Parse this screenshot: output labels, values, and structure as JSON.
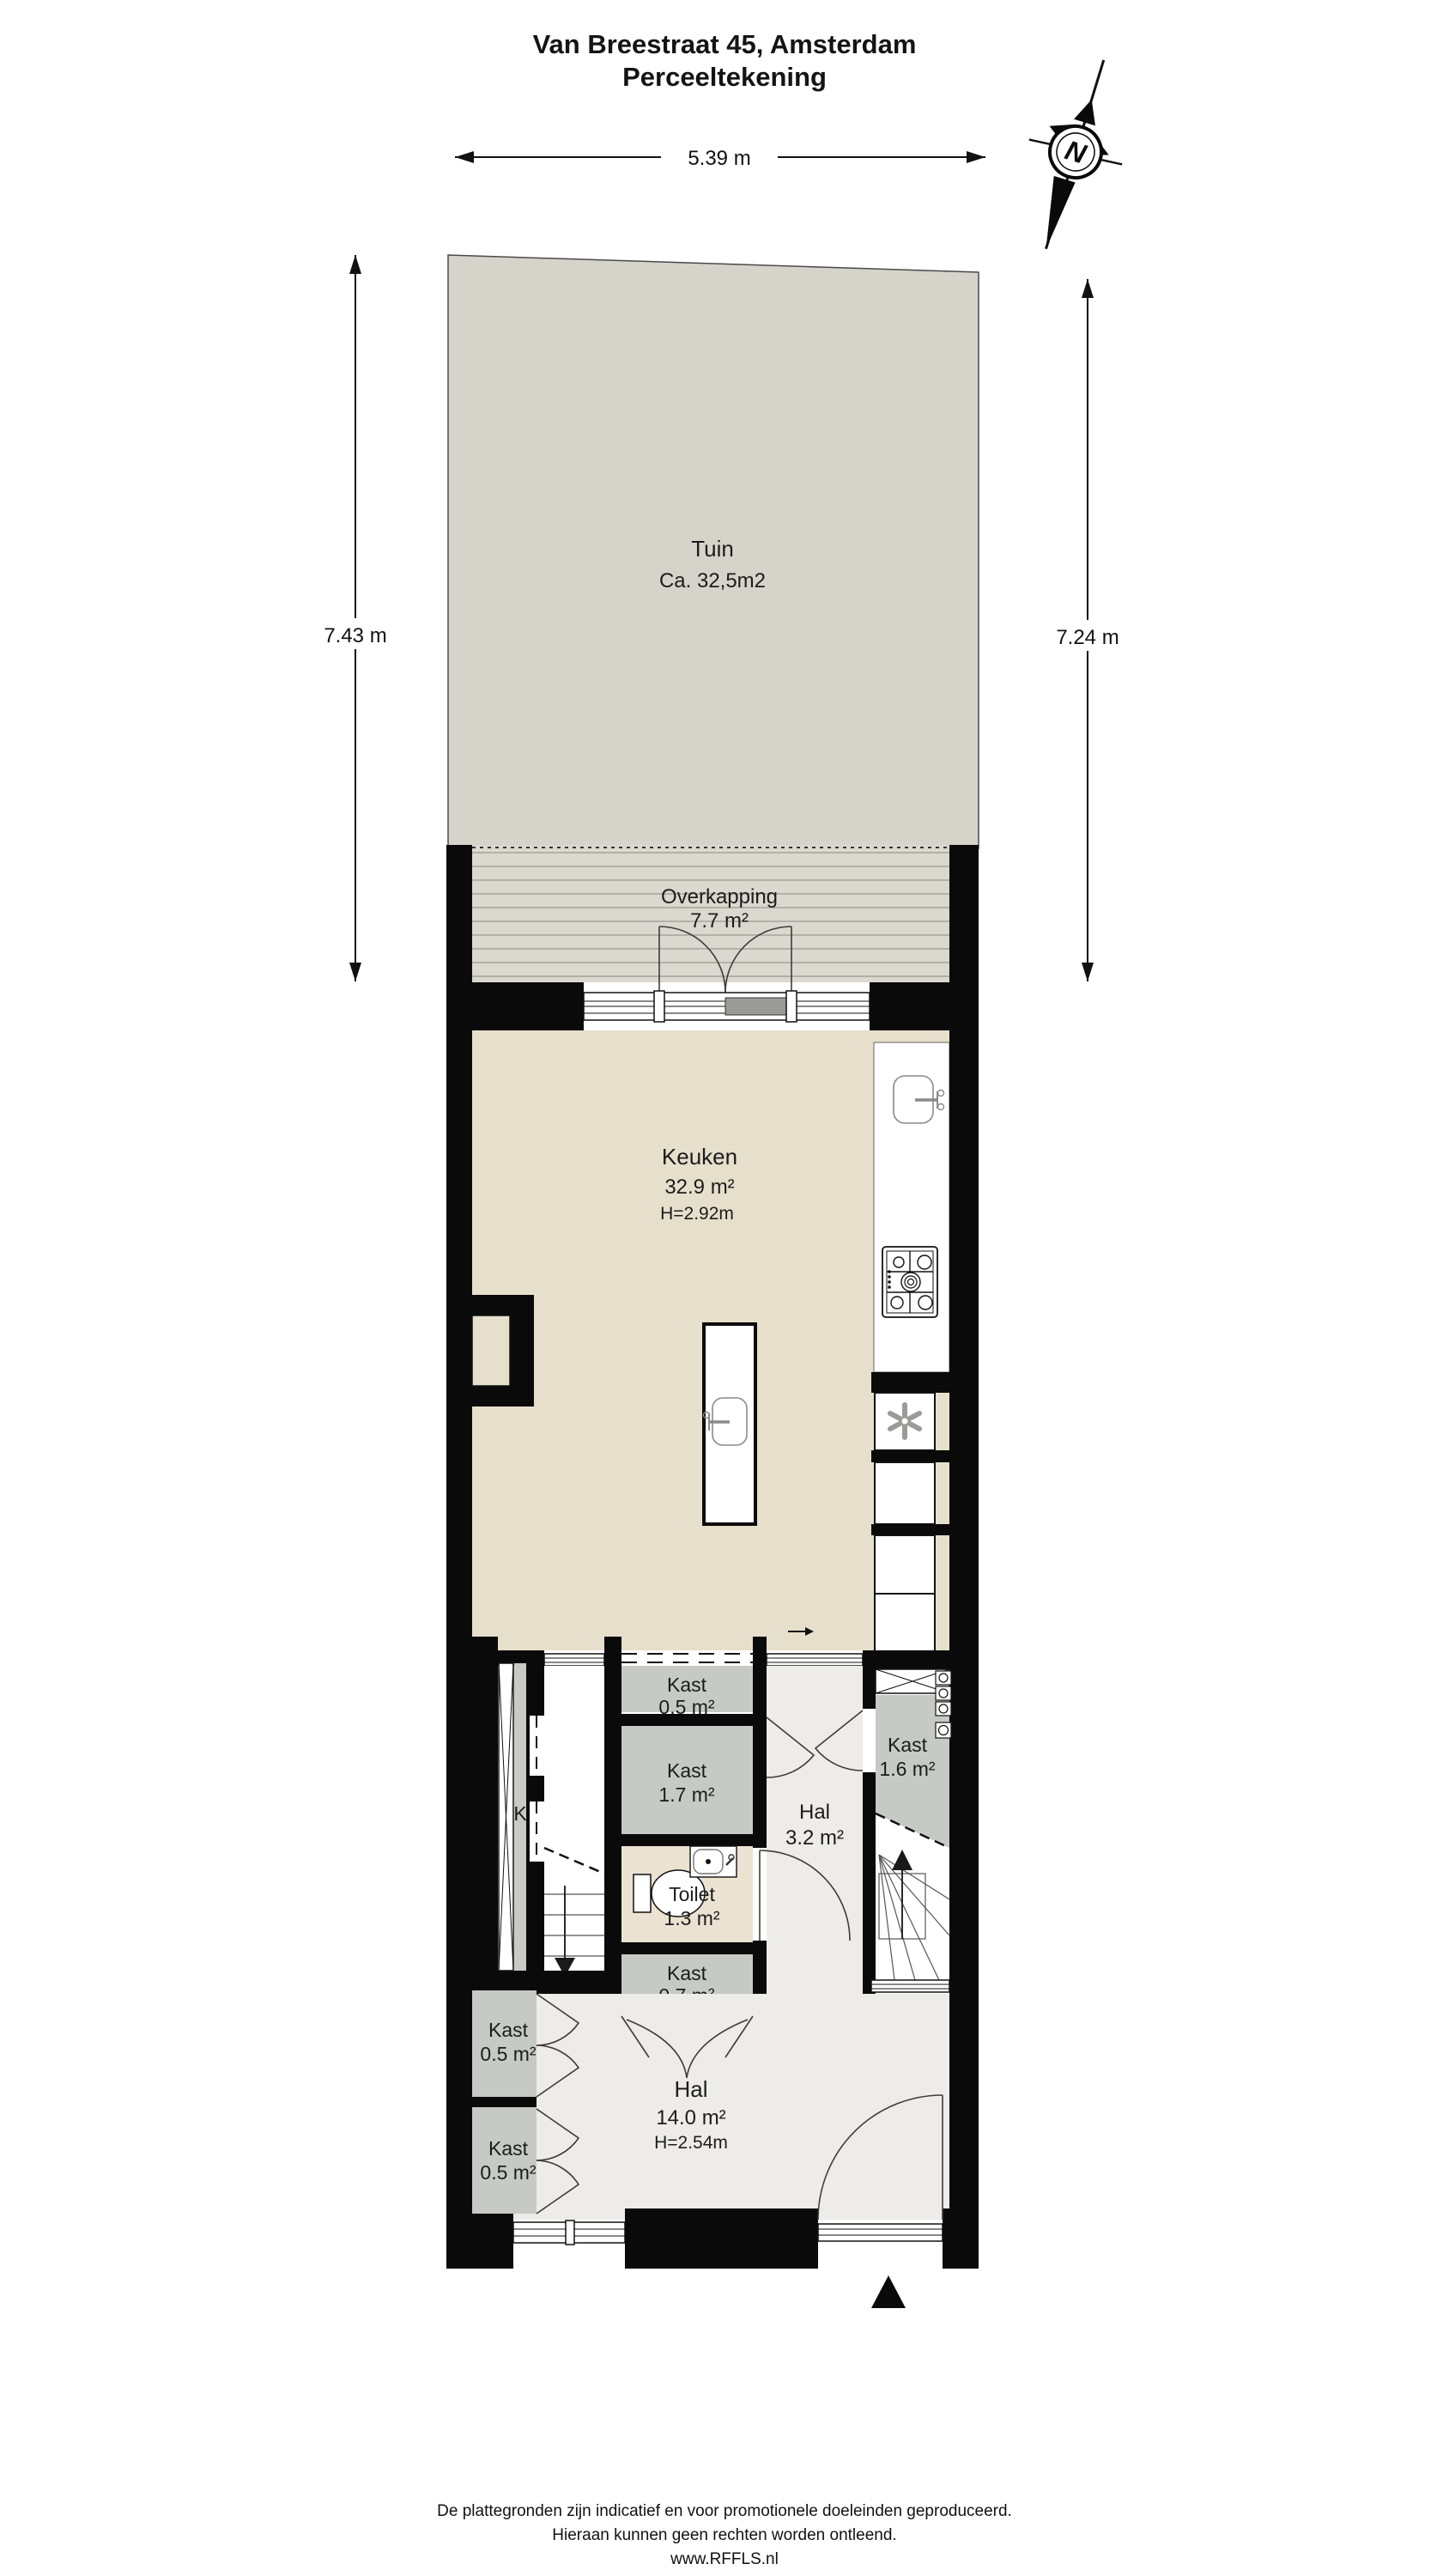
{
  "title": {
    "line1": "Van Breestraat 45, Amsterdam",
    "line2": "Perceeltekening"
  },
  "compass": {
    "north_label": "N"
  },
  "dimensions": {
    "top_width": "5.39 m",
    "left_height": "7.43 m",
    "right_height": "7.24 m"
  },
  "rooms": {
    "tuin": {
      "name": "Tuin",
      "area": "Ca. 32,5m2"
    },
    "overkapping": {
      "name": "Overkapping",
      "area": "7.7 m²"
    },
    "keuken": {
      "name": "Keuken",
      "area": "32.9 m²",
      "height": "H=2.92m"
    },
    "kast_top": {
      "name": "Kast",
      "area": "0.5 m²"
    },
    "kast_17": {
      "name": "Kast",
      "area": "1.7 m²"
    },
    "toilet": {
      "name": "Toilet",
      "area": "1.3 m²"
    },
    "hal_klein": {
      "name": "Hal",
      "area": "3.2 m²"
    },
    "kast_16": {
      "name": "Kast",
      "area": "1.6 m²"
    },
    "kast_07": {
      "name": "Kast",
      "area": "0.7 m²"
    },
    "kast_links_boven": {
      "name": "Kast",
      "area": "0.5 m²"
    },
    "kast_links_onder": {
      "name": "Kast",
      "area": "0.5 m²"
    },
    "hal_groot": {
      "name": "Hal",
      "area": "14.0 m²",
      "height": "H=2.54m"
    },
    "shaft": {
      "label": "K"
    }
  },
  "footer": {
    "line1": "De plattegronden zijn indicatief en voor promotionele doeleinden geproduceerd.",
    "line2": "Hieraan kunnen geen rechten worden ontleend.",
    "line3": "www.RFFLS.nl"
  },
  "colors": {
    "wall": "#0a0a0a",
    "garden": "#d6d3ca",
    "canopy": "#dbd8cf",
    "canopy_stripe": "#b3b0a7",
    "kitchen_floor": "#e6dfcb",
    "toilet_floor": "#ebe2d2",
    "closet_gray": "#c6c9c4",
    "hall_gray": "#edece8",
    "shaft_gray": "#c9c9c5"
  }
}
